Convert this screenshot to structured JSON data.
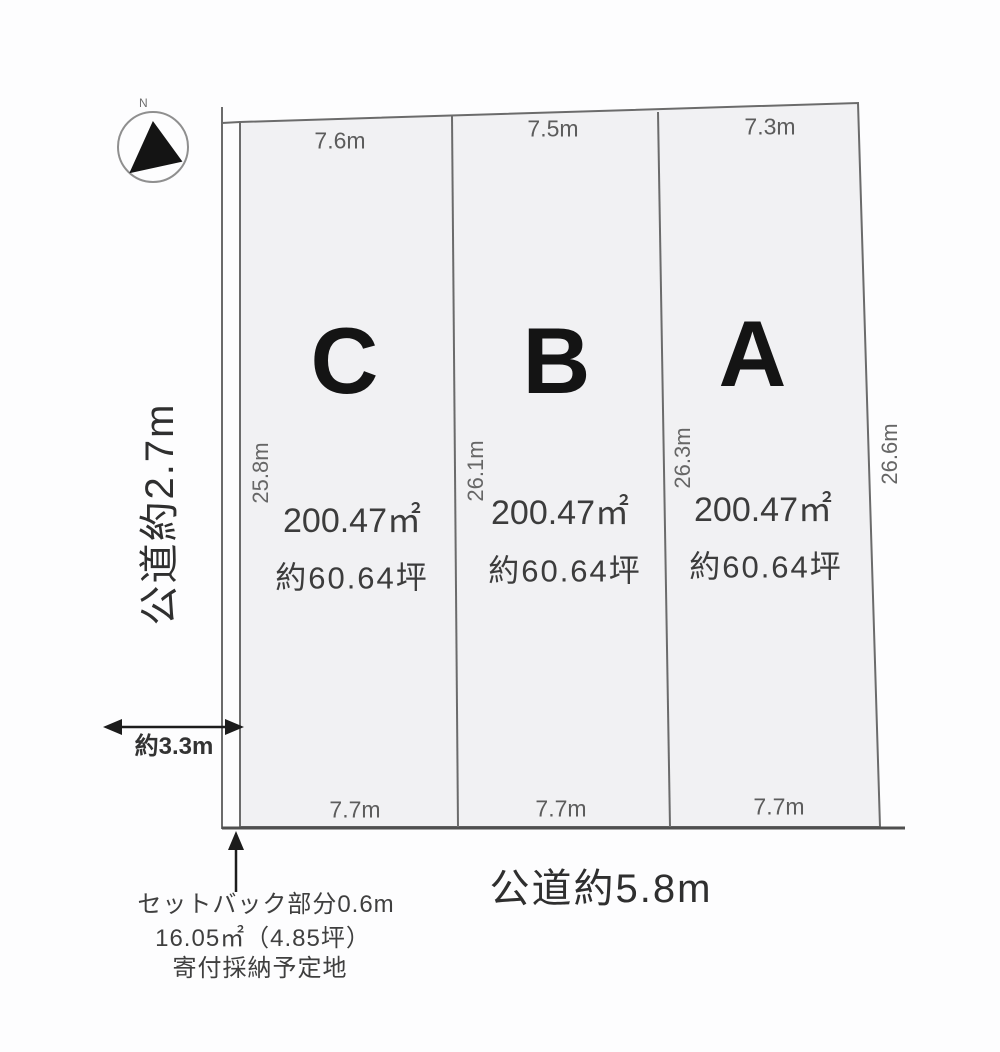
{
  "compass": {
    "north_label": "N"
  },
  "left_road": {
    "label": "公道約2.7m"
  },
  "bottom_road": {
    "label": "公道約5.8m"
  },
  "setback": {
    "arrow_label": "約3.3m",
    "line1": "セットバック部分0.6m",
    "line2": "16.05㎡（4.85坪）",
    "line3": "寄付採納予定地"
  },
  "plots": [
    {
      "id": "C",
      "top_width": "7.6m",
      "bottom_width": "7.7m",
      "depth_left": "25.8m",
      "area": "200.47㎡",
      "tsubo": "約60.64坪"
    },
    {
      "id": "B",
      "top_width": "7.5m",
      "bottom_width": "7.7m",
      "depth_left": "26.1m",
      "area": "200.47㎡",
      "tsubo": "約60.64坪"
    },
    {
      "id": "A",
      "top_width": "7.3m",
      "bottom_width": "7.7m",
      "depth_left": "26.3m",
      "depth_right": "26.6m",
      "area": "200.47㎡",
      "tsubo": "約60.64坪"
    }
  ],
  "colors": {
    "plot_fill": "#f1f1f3",
    "boundary_line": "#6b6b6b",
    "bottom_line": "#4f4f4f",
    "arrow": "#1c1c1c",
    "plot_letter": "#141414",
    "dimension_text": "#5c5c5c"
  }
}
